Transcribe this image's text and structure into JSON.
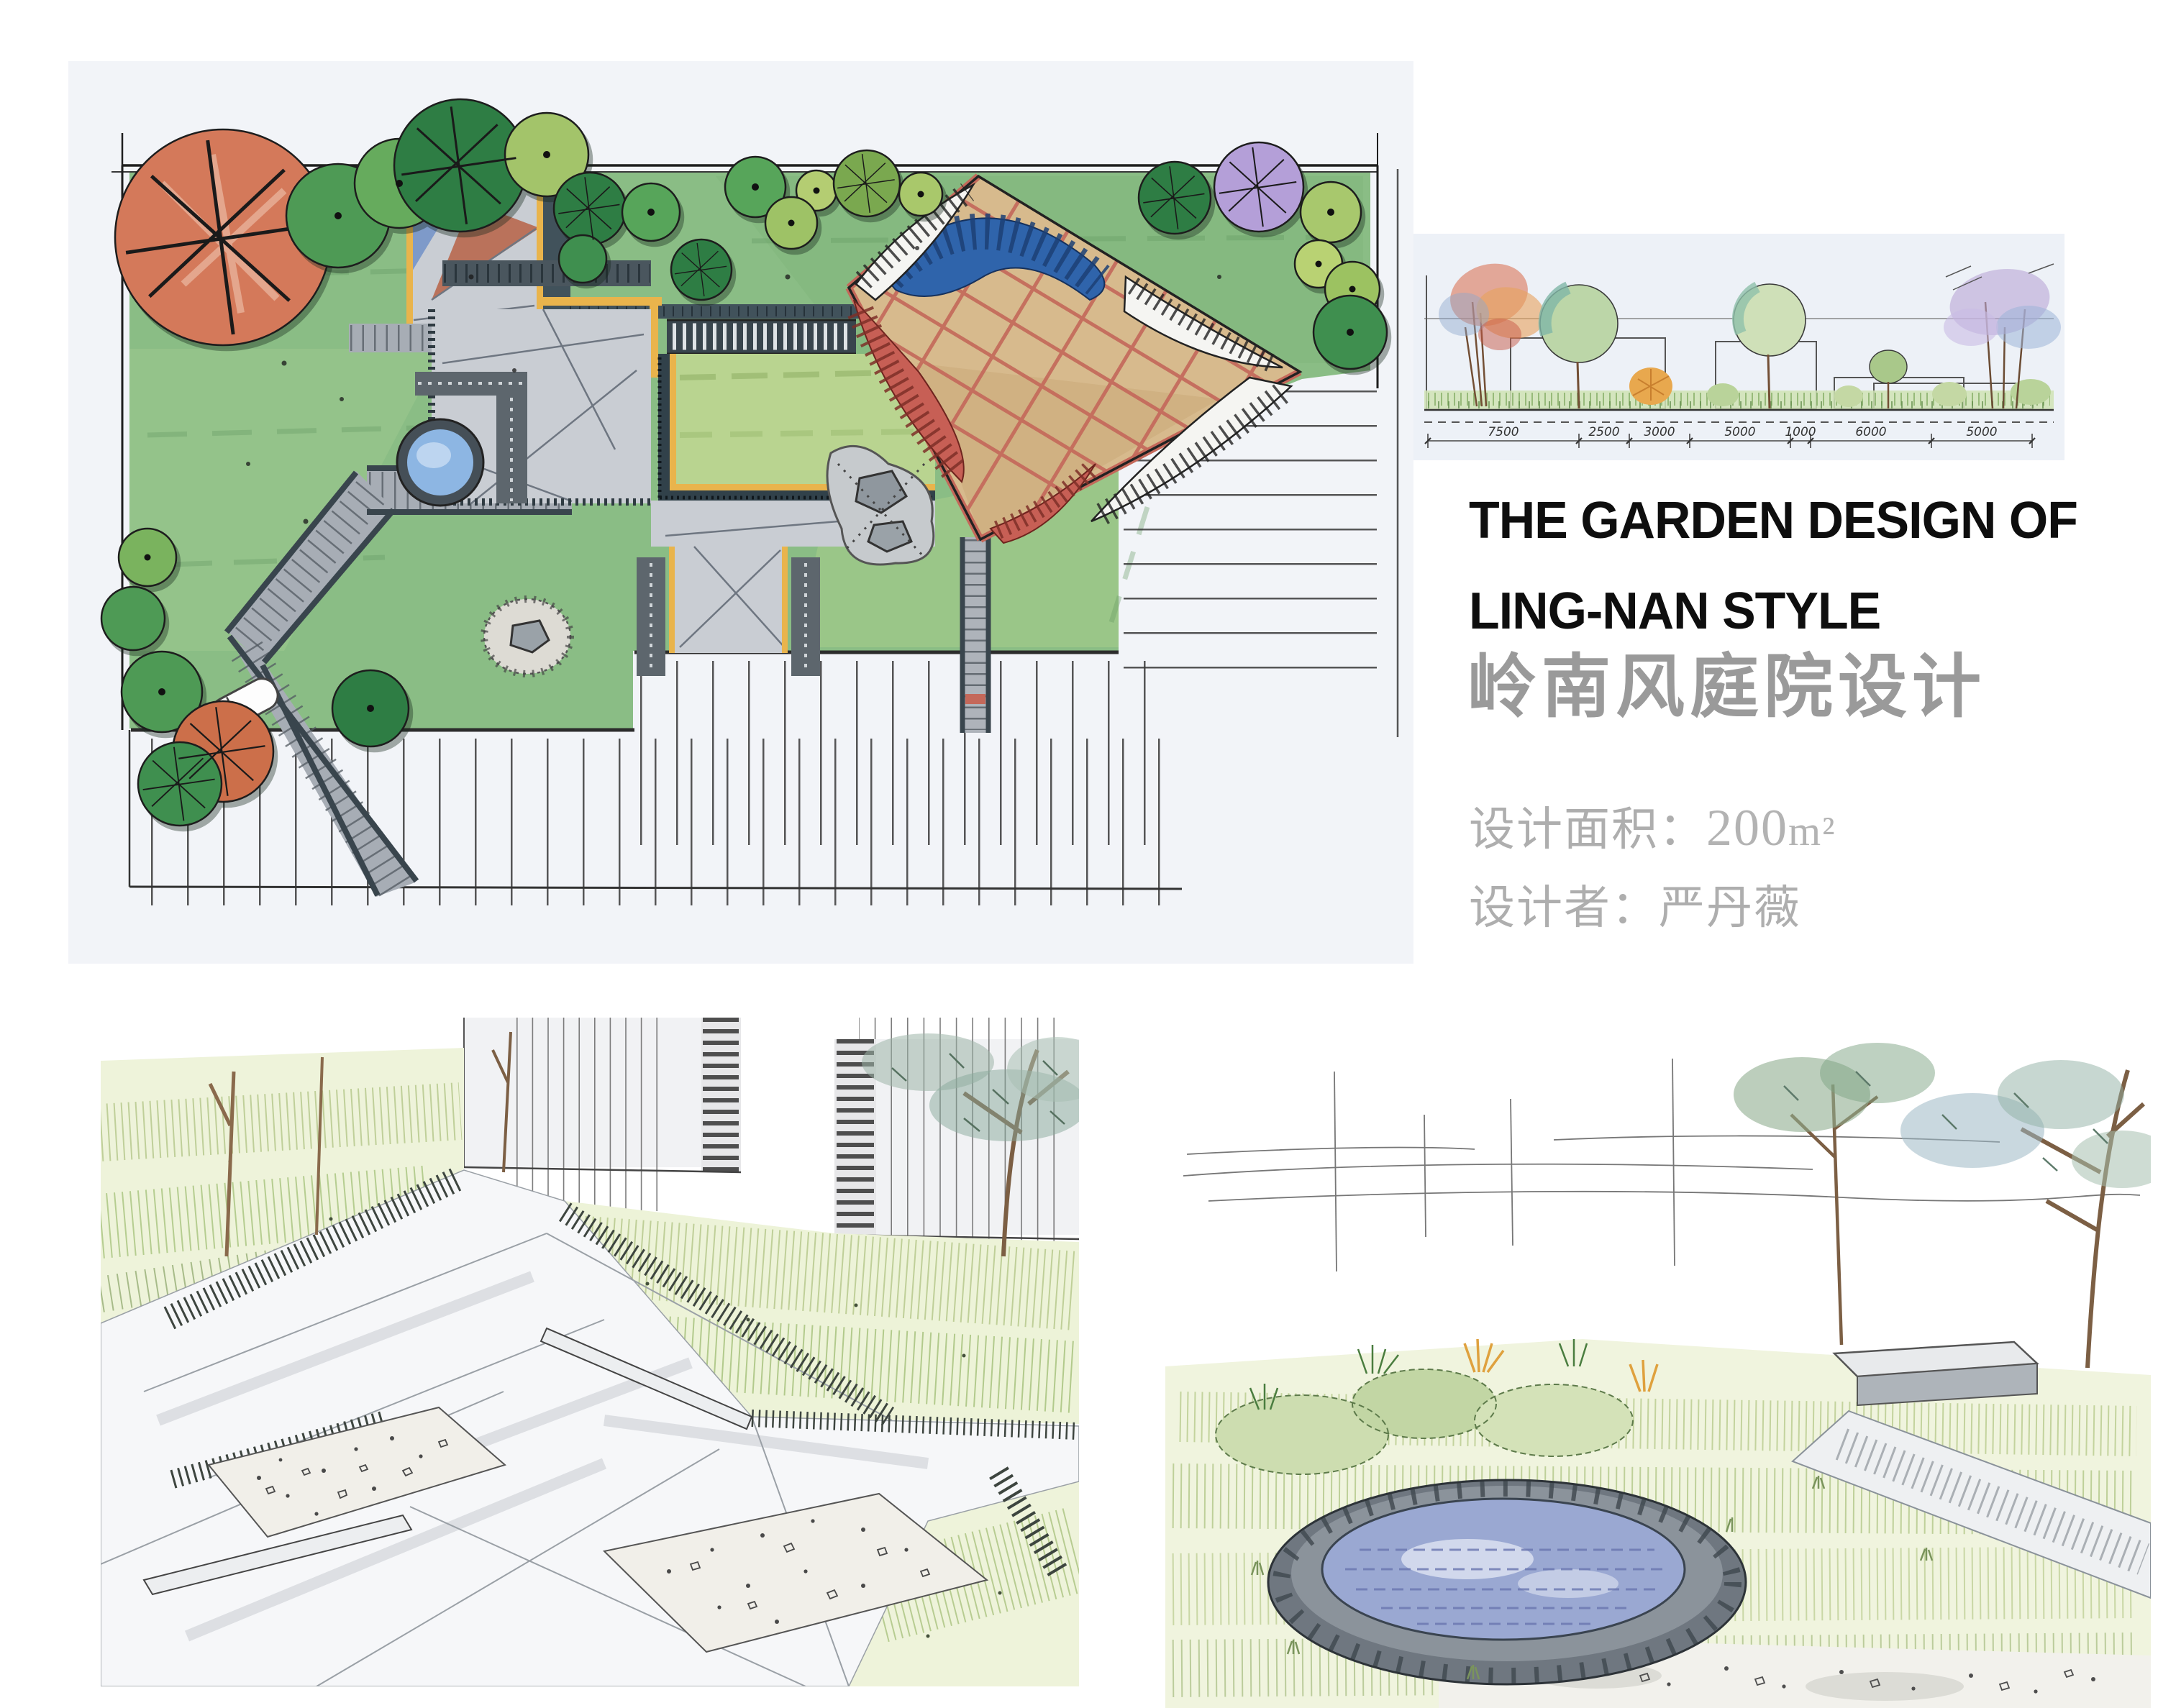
{
  "board": {
    "title": {
      "en_line1": "THE GARDEN DESIGN OF",
      "en_line2": "LING-NAN STYLE",
      "zh": "岭南风庭院设计"
    },
    "details": {
      "area_label": "设计面积：",
      "area_value": "200",
      "area_unit": "m²",
      "designer": "设计者：严丹薇"
    }
  },
  "elevation": {
    "dims": [
      "7500",
      "2500",
      "3000",
      "5000",
      "1000",
      "6000",
      "5000"
    ]
  },
  "colors": {
    "lawn_green": "#8abd85",
    "lawn_light": "#b9d490",
    "tree_dark_green": "#2e7d44",
    "tree_mid_green": "#57a55a",
    "tree_light_green": "#a9c86b",
    "tree_olive": "#8a9a3f",
    "tree_orange": "#d4795a",
    "tree_purple": "#b49fd8",
    "paving_gray": "#c9cdd3",
    "edge_dark": "#3c4a52",
    "edge_yellow": "#e9b44c",
    "deck_tan": "#d7ba8d",
    "lattice_red": "#c4685a",
    "awning_blue": "#2f64ab",
    "pond_water_plan": "#8db6e3",
    "pond_water_sketch": "#9aa8d2",
    "title_black": "#0e0e0e",
    "title_gray": "#9a9a9a",
    "meta_gray": "#aeaeae"
  }
}
